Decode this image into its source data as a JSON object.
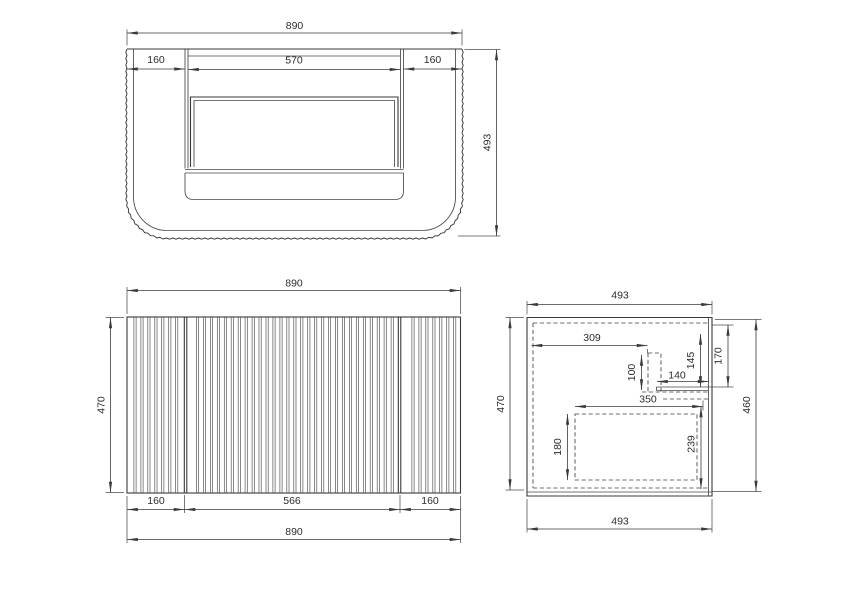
{
  "colors": {
    "background": "#ffffff",
    "line": "#3a3a3a",
    "text": "#2d2d2d"
  },
  "plan": {
    "d890": "890",
    "d160_left": "160",
    "d570": "570",
    "d160_right": "160",
    "d493": "493"
  },
  "front": {
    "d890_top": "890",
    "d470": "470",
    "d160_left": "160",
    "d566": "566",
    "d160_right": "160",
    "d890_bottom": "890"
  },
  "side": {
    "d493_top": "493",
    "d470": "470",
    "d460": "460",
    "d493_bottom": "493",
    "d309": "309",
    "d100": "100",
    "d140": "140",
    "d145": "145",
    "d170": "170",
    "d350": "350",
    "d180": "180",
    "d239": "239"
  }
}
